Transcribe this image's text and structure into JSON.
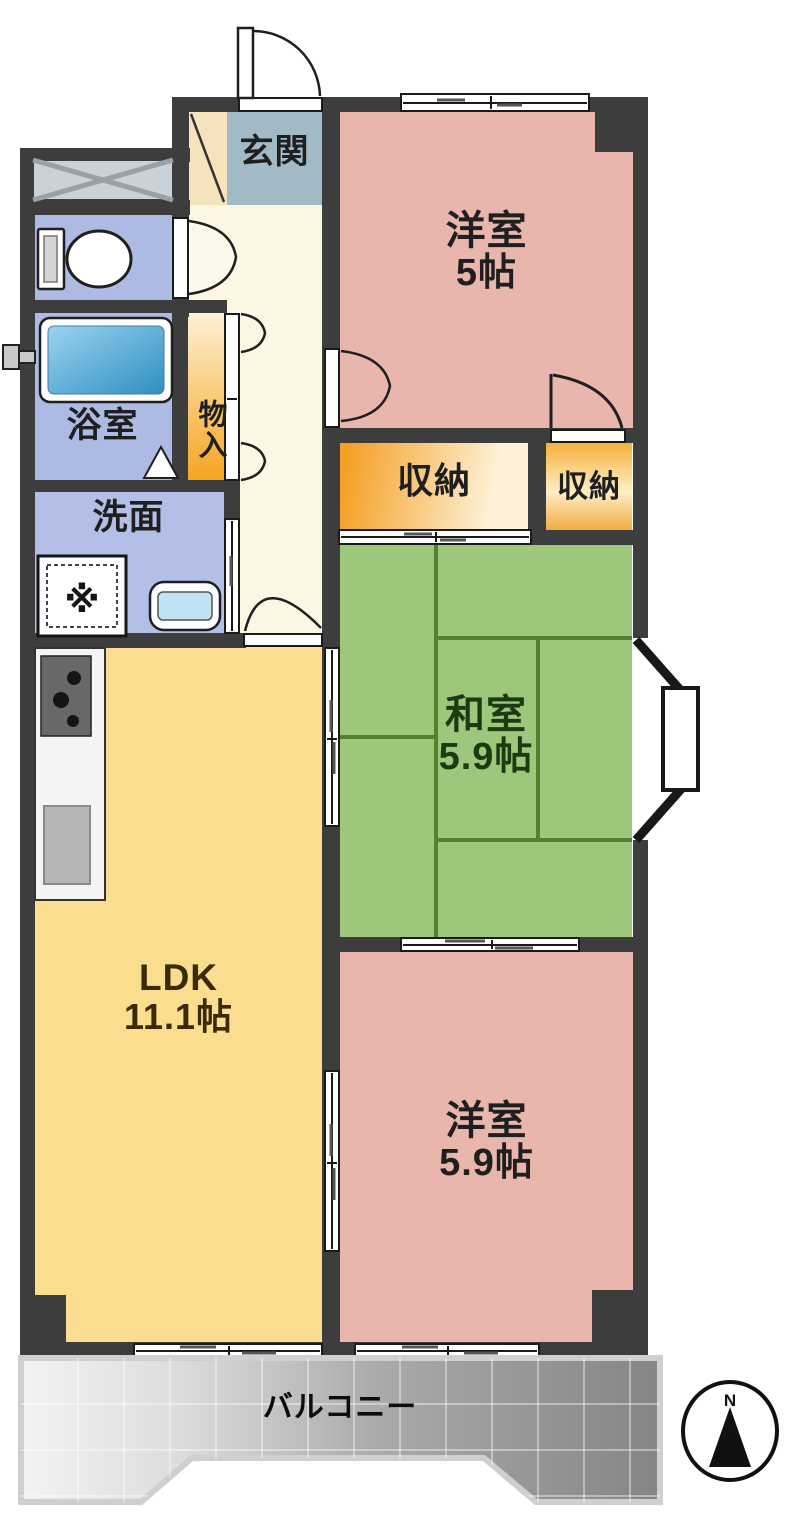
{
  "title": "2LDK+和室 マンション間取り図",
  "rooms": {
    "genkan": {
      "label": "玄関"
    },
    "western5": {
      "label": "洋室",
      "area": "5帖"
    },
    "monoire": {
      "label": "物入"
    },
    "closet_left": {
      "label": "収納"
    },
    "closet_right": {
      "label": "収納"
    },
    "washitsu": {
      "label": "和室",
      "area": "5.9帖"
    },
    "bathroom": {
      "label": "浴室"
    },
    "washroom": {
      "label": "洗面"
    },
    "ldk": {
      "label": "LDK",
      "area": "11.1帖"
    },
    "western59": {
      "label": "洋室",
      "area": "5.9帖"
    },
    "balcony": {
      "label": "バルコニー"
    }
  },
  "symbols": {
    "washing_machine": "※",
    "compass_north": "N"
  },
  "colors": {
    "wall": "#3d3d3d",
    "western_room_pink": "#e9b6ad",
    "japanese_room_green": "#9dc87b",
    "tatami_line_green": "#55812f",
    "ldk_yellow": "#fadd8e",
    "hallway_cream": "#fcf6e3",
    "genkan_tile_blue": "#a2bac5",
    "genkan_step_tan": "#f5e3bd",
    "wet_area_periwinkle": "#adbae3",
    "storage_orange": "#f4a025",
    "storage_pale": "#fdf2d8",
    "bathtub_blue": "#2f8fc2",
    "balcony_gray_dark": "#858585",
    "balcony_gray_light": "#f3f3f3"
  }
}
